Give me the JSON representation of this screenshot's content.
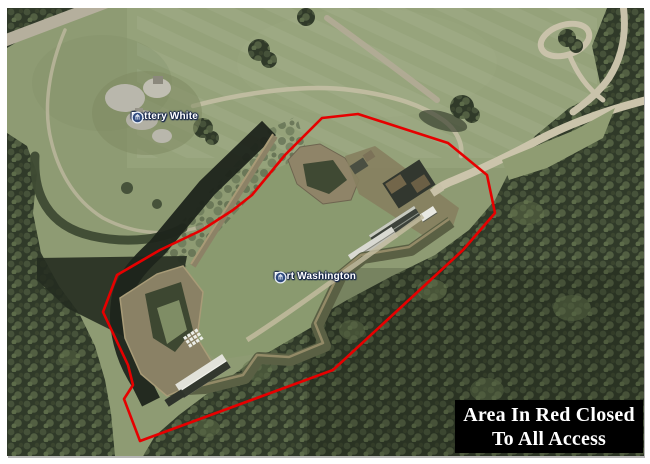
{
  "canvas": {
    "width": 650,
    "height": 464,
    "background": "#ffffff"
  },
  "map": {
    "type": "satellite-aerial-view",
    "markers": [
      {
        "id": "battery-white",
        "label": "Battery White",
        "x": 130,
        "y": 110,
        "pin_color": "#2f4a7e",
        "pin_ring": "#e6ecf5"
      },
      {
        "id": "fort-washington",
        "label": "Fort Washington",
        "x": 273,
        "y": 270,
        "pin_color": "#2f4a7e",
        "pin_ring": "#e6ecf5"
      }
    ],
    "restricted_area": {
      "outline_color": "#e60000",
      "outline_width": 2.6,
      "points": [
        [
          351,
          106
        ],
        [
          441,
          135
        ],
        [
          480,
          167
        ],
        [
          488,
          205
        ],
        [
          456,
          242
        ],
        [
          326,
          362
        ],
        [
          133,
          433
        ],
        [
          117,
          391
        ],
        [
          126,
          377
        ],
        [
          121,
          357
        ],
        [
          96,
          304
        ],
        [
          110,
          267
        ],
        [
          153,
          242
        ],
        [
          195,
          222
        ],
        [
          226,
          202
        ],
        [
          245,
          187
        ],
        [
          278,
          147
        ],
        [
          315,
          110
        ],
        [
          351,
          106
        ]
      ]
    }
  },
  "notice": {
    "line1": "Area In Red Closed",
    "line2": "To All Access",
    "bg": "#000000",
    "color": "#ffffff"
  }
}
